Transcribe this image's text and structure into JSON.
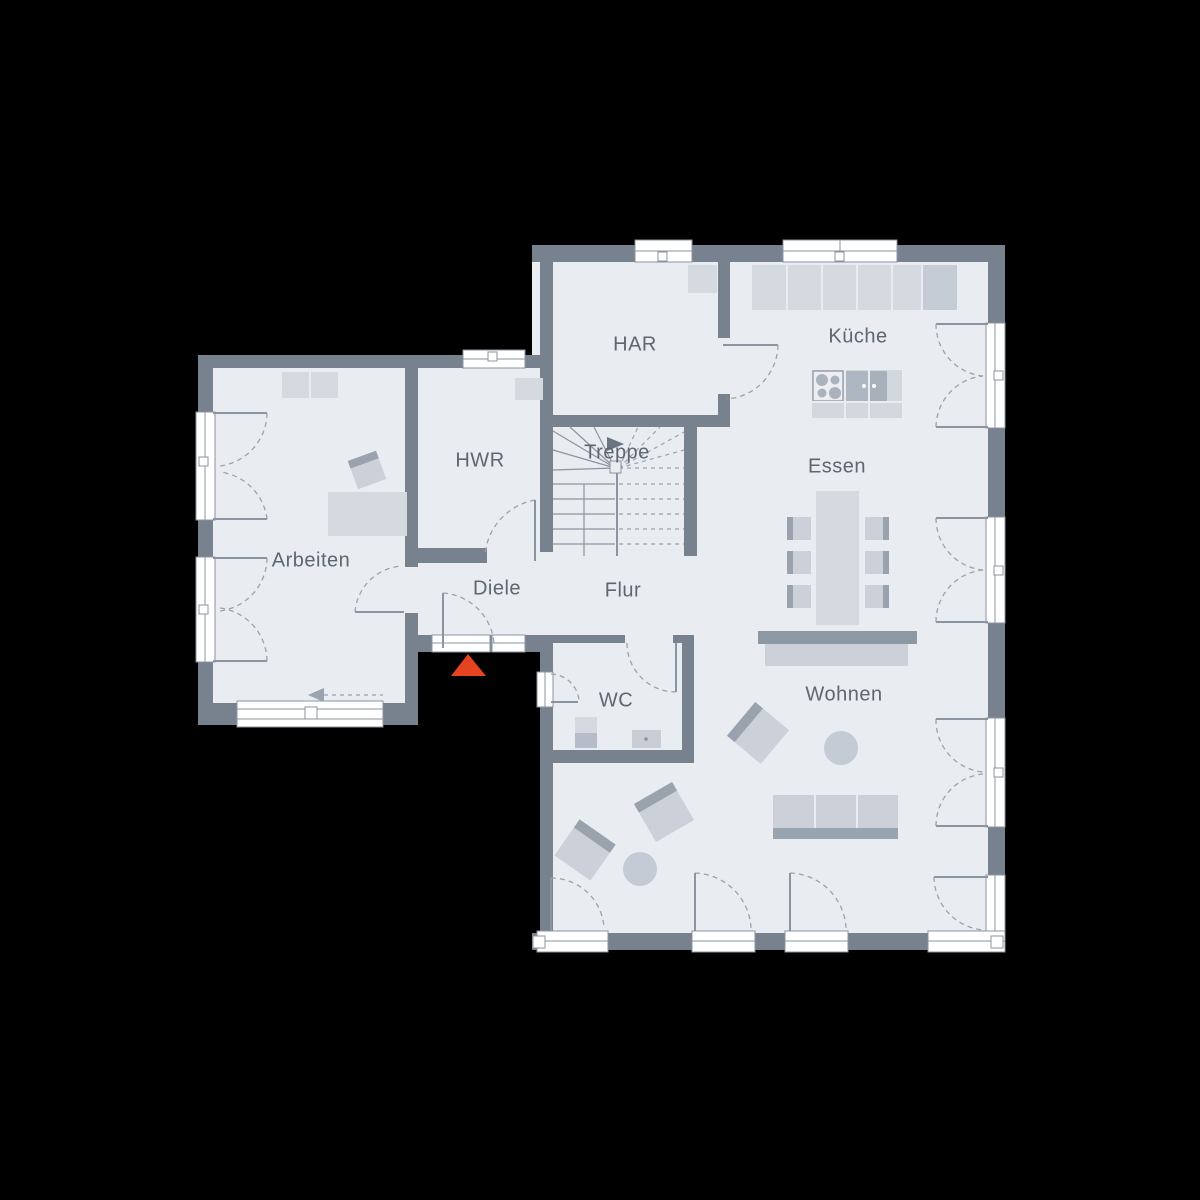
{
  "floorplan": {
    "rooms": [
      {
        "id": "har",
        "label": "HAR"
      },
      {
        "id": "kueche",
        "label": "Küche"
      },
      {
        "id": "hwr",
        "label": "HWR"
      },
      {
        "id": "treppe",
        "label": "Treppe"
      },
      {
        "id": "essen",
        "label": "Essen"
      },
      {
        "id": "arbeiten",
        "label": "Arbeiten"
      },
      {
        "id": "diele",
        "label": "Diele"
      },
      {
        "id": "flur",
        "label": "Flur"
      },
      {
        "id": "wc",
        "label": "WC"
      },
      {
        "id": "wohnen",
        "label": "Wohnen"
      }
    ],
    "colors": {
      "background": "#000000",
      "wall": "#78828f",
      "floor": "#e9ecf1",
      "furniture_light": "#d5dae1",
      "furniture_dark": "#9aa2ae",
      "label_text": "#5d6671",
      "entrance_accent": "#e54420"
    }
  }
}
